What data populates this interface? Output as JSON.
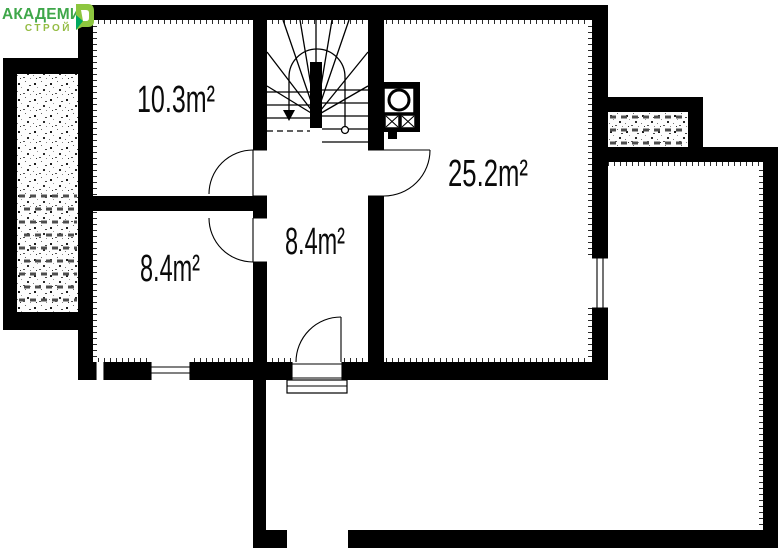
{
  "logo": {
    "name": "АКАДЕМИК",
    "sub": "СТРОЙ",
    "name_color": "#3FA74A",
    "sub_color": "#94BC43",
    "icon_light_green": "#8DC63F",
    "icon_dark_green": "#00A860"
  },
  "plan": {
    "wall_color": "#000000",
    "background_color": "#ffffff",
    "rooms": [
      {
        "name": "top-left-room",
        "label": "10.3m²"
      },
      {
        "name": "right-room",
        "label": "25.2m²"
      },
      {
        "name": "hall",
        "label": "8.4m²"
      },
      {
        "name": "bottom-left-room",
        "label": "8.4m²"
      }
    ]
  }
}
